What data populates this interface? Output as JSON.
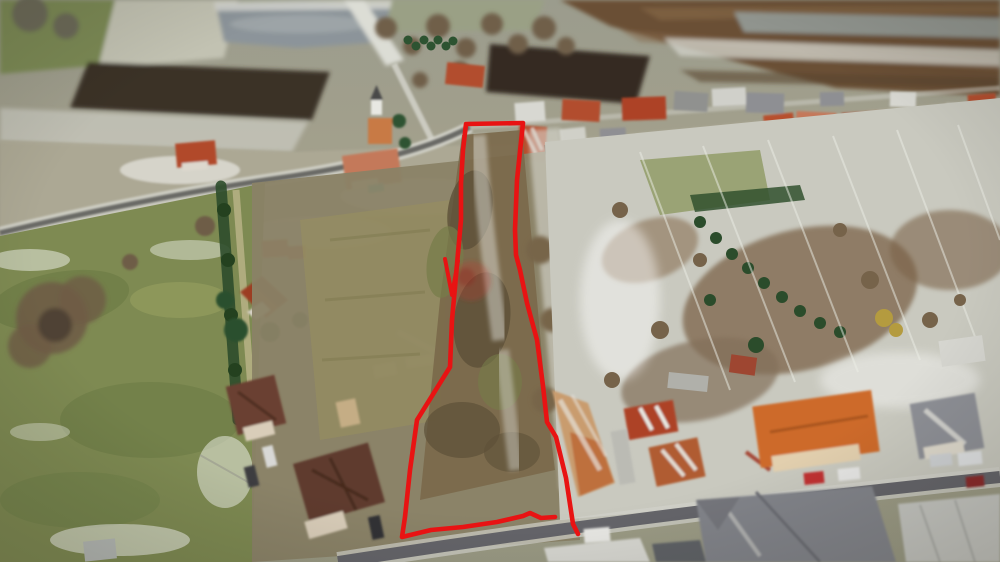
{
  "meta": {
    "image_type": "aerial-drone-photograph",
    "scene": "Winter aerial view of a village with patchy snow; a long narrow building plot is outlined in red, running from the village street at top down to a lower road, between gardens and family houses",
    "visible_text": "none",
    "season": "winter, melting snow"
  },
  "overlay": {
    "outline_color": "#e81313",
    "outline_width": 4.6,
    "parcel_outline_points": "578,534 573,524 566,478 556,437 547,422 543,386 537,340 527,303 520,270 516,255 515,230 517,180 523,123 466,124 463,150 461,183 461,220 458,253 455,287 452,320 450,367 417,420 410,470 405,517 402,537 431,530 463,527 497,522 523,516 530,513 541,518 555,517",
    "outline_tick_points": "445,259 452,295 458,261",
    "watermark_color": "#b8342a",
    "watermark_opacity": 0.3
  },
  "palette": {
    "outline_red": "#e81313",
    "meadow_green": "#7e8a52",
    "snow": "#dcdcd6",
    "plowed_field_dark": "#3a3026",
    "field_brown": "#6b5036",
    "pond_grey": "#8c949a",
    "roof_red": "#b24e2d",
    "roof_orange": "#cd6a2c",
    "roof_brown": "#6b4130",
    "roof_grey": "#8e9096",
    "road_asphalt": "#65656a",
    "conifer_green": "#2d5331",
    "bare_tree_brown": "#6e5d46",
    "scrub_brown": "#7a684a"
  }
}
